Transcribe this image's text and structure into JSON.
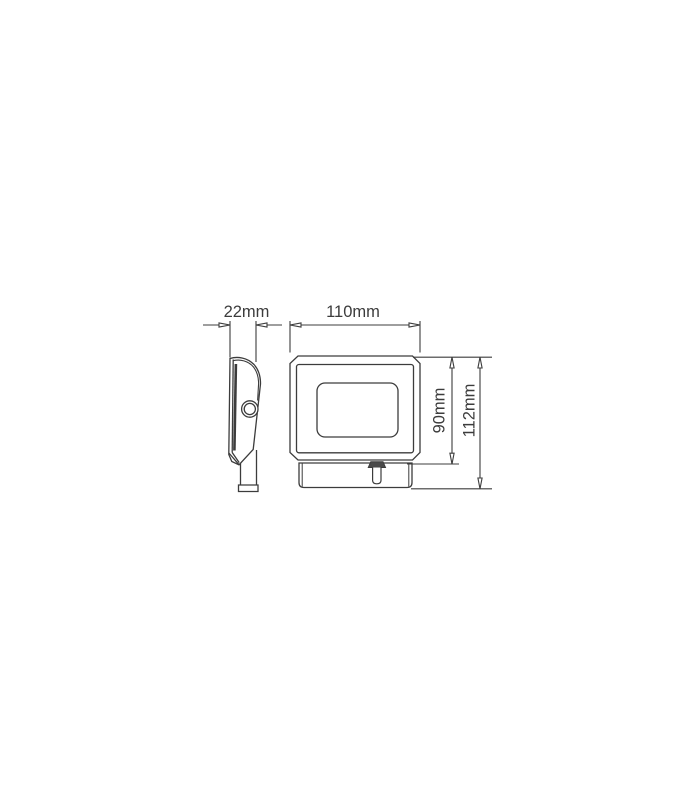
{
  "page": {
    "background": "#ffffff",
    "description": "Technical dimension drawing of an LED floodlight, side view and front view"
  },
  "diagram": {
    "line_color": "#3c3c3c",
    "text_color": "#3c3c3c",
    "gland_fill": "#4a4a4a",
    "views": {
      "side": "side-profile-view",
      "front": "front-view"
    },
    "dimensions": {
      "depth": "22mm",
      "width": "110mm",
      "body_height": "90mm",
      "total_height": "112mm"
    }
  }
}
